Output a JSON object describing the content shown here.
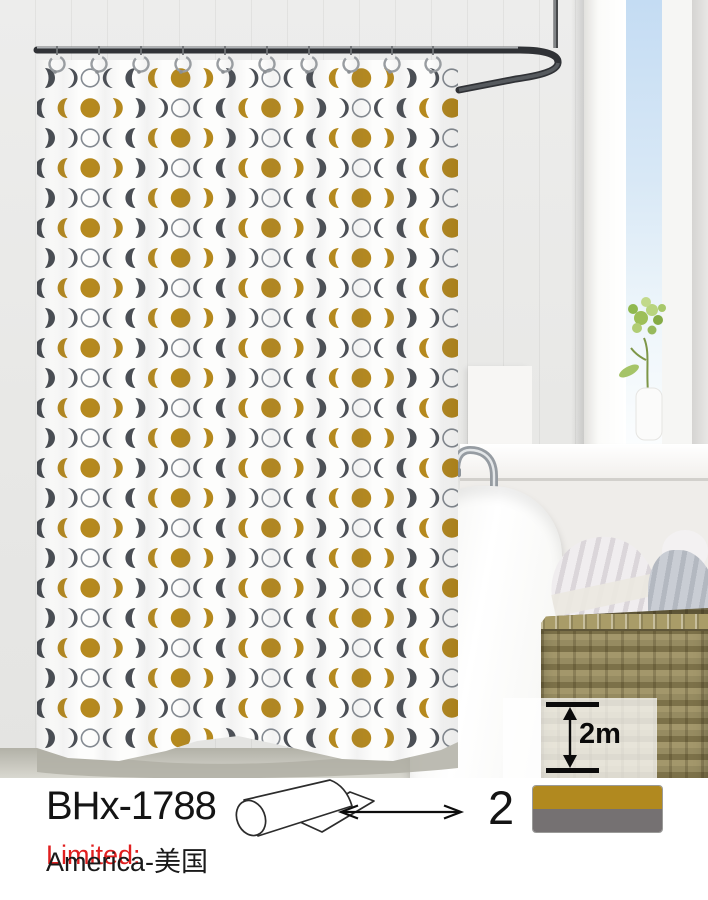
{
  "product": {
    "model": "BHx-1788",
    "quantity": "2",
    "height": "2m",
    "limited_label": "Limited:",
    "limited_region": "America-美国"
  },
  "swatch": {
    "top_color": "#b1891f",
    "bottom_color": "#757172"
  },
  "curtain_pattern": {
    "description": "moon-phase repeat: outlined new moon, thin and bold dark waxing crescents, gold crescent, gold full moon, gold waning crescent, bold and thin dark waning crescents",
    "sequence": [
      "circle-outline",
      "crescent-left-thin",
      "crescent-left-bold",
      "crescent-left-gold",
      "circle-gold",
      "crescent-right-gold",
      "crescent-right-bold",
      "crescent-right-thin"
    ],
    "colors": {
      "gold": "#b5891e",
      "dark": "#4b4f55",
      "outline": "#858b92"
    },
    "rows": 23,
    "cols": 19,
    "phase_even_row_start": 6,
    "phase_odd_row_start": 2
  },
  "icons": {
    "roll": "curtain-roll-icon",
    "width_arrow": "width-arrow-icon",
    "height_arrow": "height-arrow-icon"
  }
}
